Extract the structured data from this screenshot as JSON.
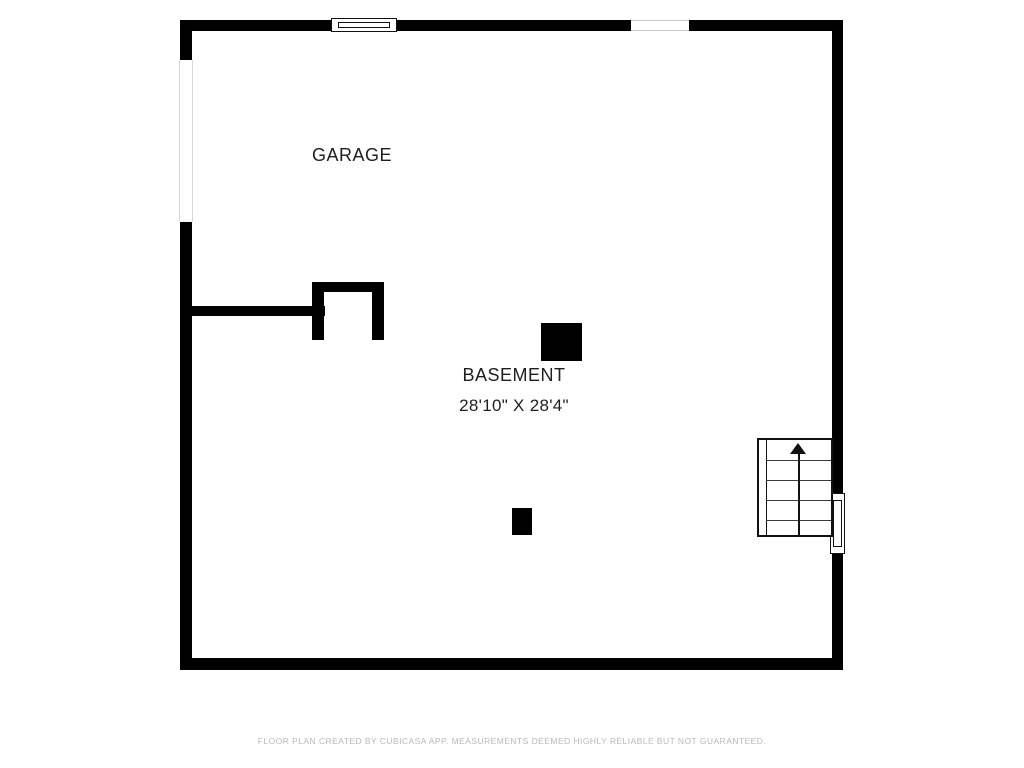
{
  "rooms": [
    {
      "name": "GARAGE"
    },
    {
      "name": "BASEMENT",
      "dimensions": "28'10\" X 28'4\""
    }
  ],
  "stairs": {
    "direction_icon": "arrow-up-icon",
    "tread_count": 5
  },
  "footer": {
    "disclaimer": "FLOOR PLAN CREATED BY CUBICASA APP. MEASUREMENTS DEEMED HIGHLY RELIABLE BUT NOT GUARANTEED."
  },
  "colors": {
    "wall": "#000000",
    "label_text": "#1f1f1f",
    "footer_text": "#b9b9b9",
    "background": "#ffffff",
    "window_border": "#111111",
    "opening_border": "#cccccc"
  }
}
